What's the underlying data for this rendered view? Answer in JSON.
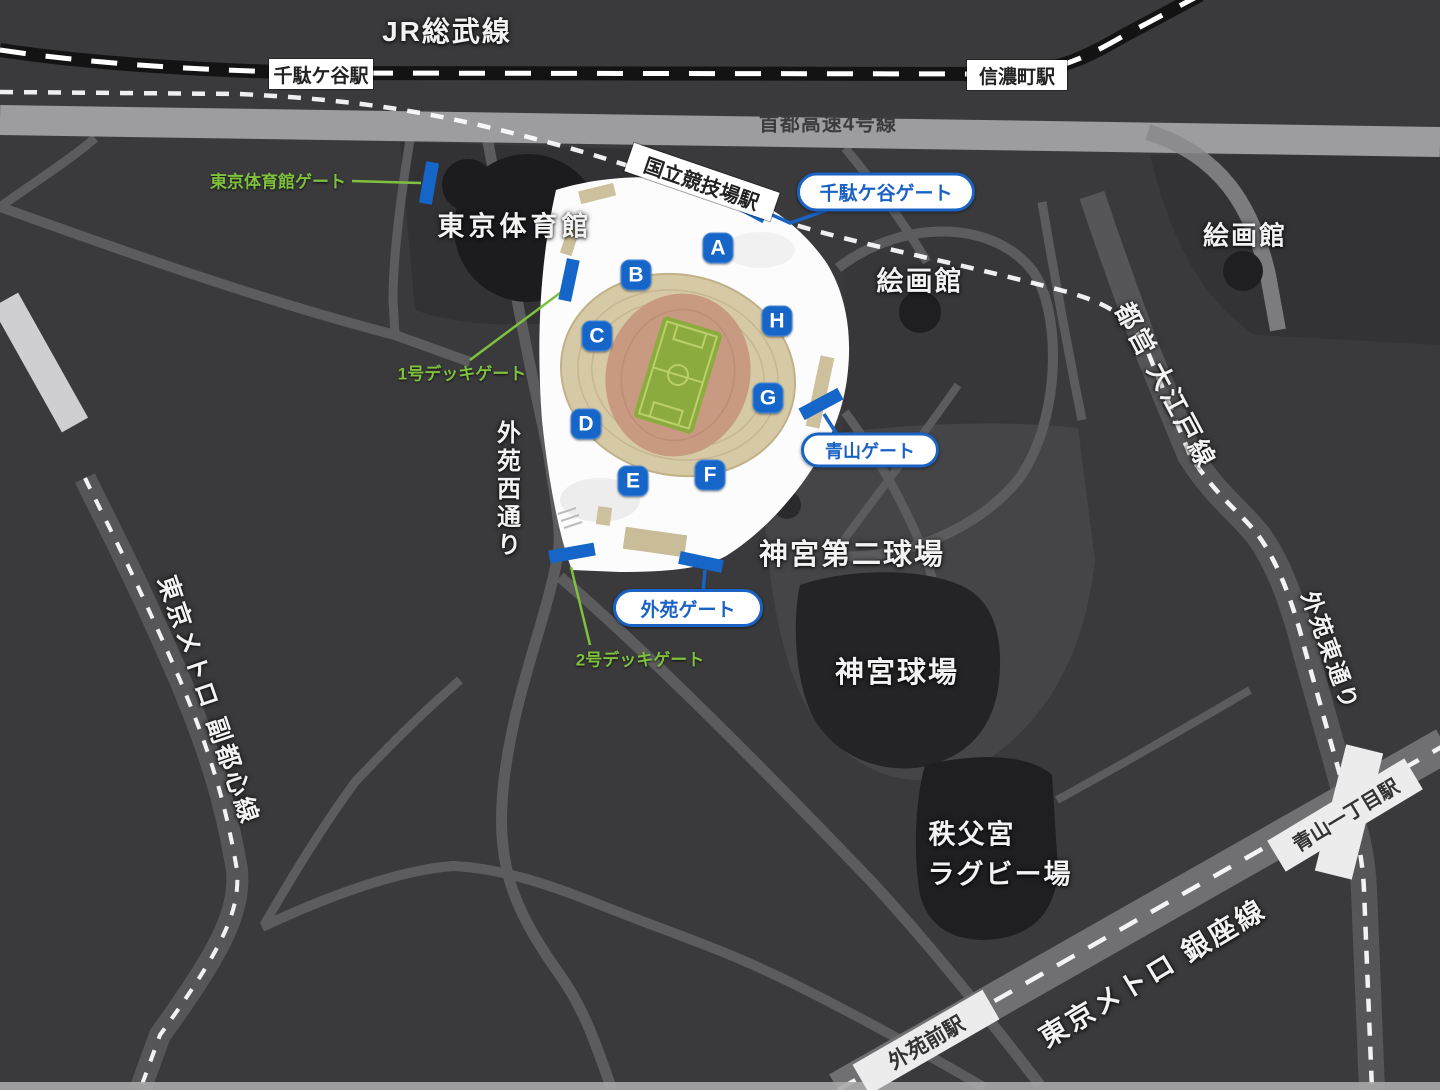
{
  "lines": {
    "jr": "JR総武線",
    "shuto_expressway": "首都高速4号線",
    "oedo": "都営 大江戸線",
    "fukutoshin": "東京メトロ 副都心線",
    "ginza": "東京メトロ 銀座線",
    "gaien_west_street": "外苑西通り",
    "gaien_east_street": "外苑東通り"
  },
  "stations": {
    "sendagaya": "千駄ケ谷駅",
    "shinanomachi": "信濃町駅",
    "kokuritsu_kyogijo": "国立競技場駅",
    "aoyama_itchome": "青山一丁目駅",
    "gaienmae": "外苑前駅"
  },
  "places": {
    "tokyo_gym": "東京体育館",
    "gallery_west": "絵画館",
    "gallery_east": "絵画館",
    "jingu_second_stadium": "神宮第二球場",
    "jingu_stadium": "神宮球場",
    "rugby_line1": "秩父宮",
    "rugby_line2": "ラグビー場"
  },
  "gates": {
    "letters": [
      "A",
      "B",
      "C",
      "D",
      "E",
      "F",
      "G",
      "H"
    ],
    "sendagaya_gate": "千駄ケ谷ゲート",
    "aoyama_gate": "青山ゲート",
    "gaien_gate": "外苑ゲート",
    "tokyo_gym_gate": "東京体育館ゲート",
    "deck1_gate": "1号デッキゲート",
    "deck2_gate": "2号デッキゲート"
  },
  "colors": {
    "gate_badge_blue": "#1566c8",
    "label_blue": "#1a63c5",
    "gate_label_green": "#7fc13e",
    "pitch_green": "#8cab3f",
    "stand_beige": "#d6c9a6",
    "track_salmon": "#c89a81",
    "background": "#3a3a3c"
  }
}
